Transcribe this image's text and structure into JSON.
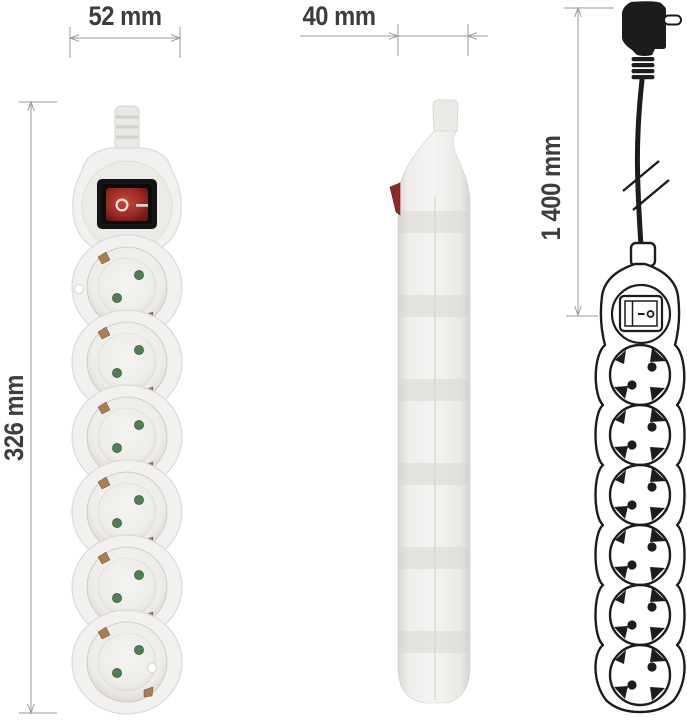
{
  "dimensions": {
    "front_width": "52 mm",
    "side_width": "40 mm",
    "strip_length": "326 mm",
    "cable_length": "1 400 mm"
  },
  "front_view": {
    "socket_count": 6,
    "switch_symbols": {
      "off": "O",
      "on": "—"
    }
  },
  "side_view": {
    "socket_count": 6
  },
  "outline_view": {
    "socket_count": 6,
    "switch_symbols": {
      "on": "—",
      "off": "o"
    }
  },
  "colors": {
    "dim_line": "#9a9a9a",
    "dim_text": "#3d3d3d",
    "line_art": "#1c1c1c",
    "switch_red": "#9b2b25",
    "switch_red_light": "#c04a3e",
    "switch_frame": "#141414",
    "green_dot": "#4e8054",
    "brass": "#a97e52",
    "body_white": "#f2f1ef",
    "body_seam": "#dcdad6",
    "side_red": "#8e2a25"
  }
}
